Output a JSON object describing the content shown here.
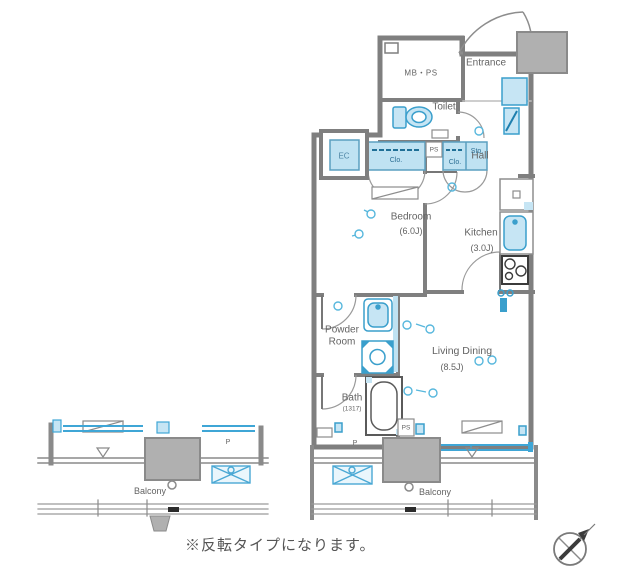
{
  "plan": {
    "note": "※反転タイプになります。",
    "labels": {
      "mb_ps": "MB・PS",
      "entrance": "Entrance",
      "toilet": "Toilet",
      "hall": "Hall",
      "ec": "EC",
      "closet_a": "Clo.",
      "ps_upper": "PS",
      "closet_b": "Clo.",
      "storage": "Sto.",
      "bedroom_name": "Bedroom",
      "bedroom_size": "(6.0J)",
      "kitchen_name": "Kitchen",
      "kitchen_size": "(3.0J)",
      "powder_room": "Powder\nRoom",
      "bath_name": "Bath",
      "bath_size": "(1317)",
      "living_name": "Living Dining",
      "living_size": "(8.5J)",
      "ps_lower": "PS",
      "balcony_left": "Balcony",
      "balcony_right": "Balcony",
      "p_left": "P",
      "p_right": "P"
    },
    "colors": {
      "wall_gray": "#7f7f7f",
      "block_gray": "#b0b0b0",
      "fixture_blue_fill": "#c6e5f4",
      "fixture_blue_stroke": "#3a9fcc",
      "text_gray": "#636363"
    }
  }
}
